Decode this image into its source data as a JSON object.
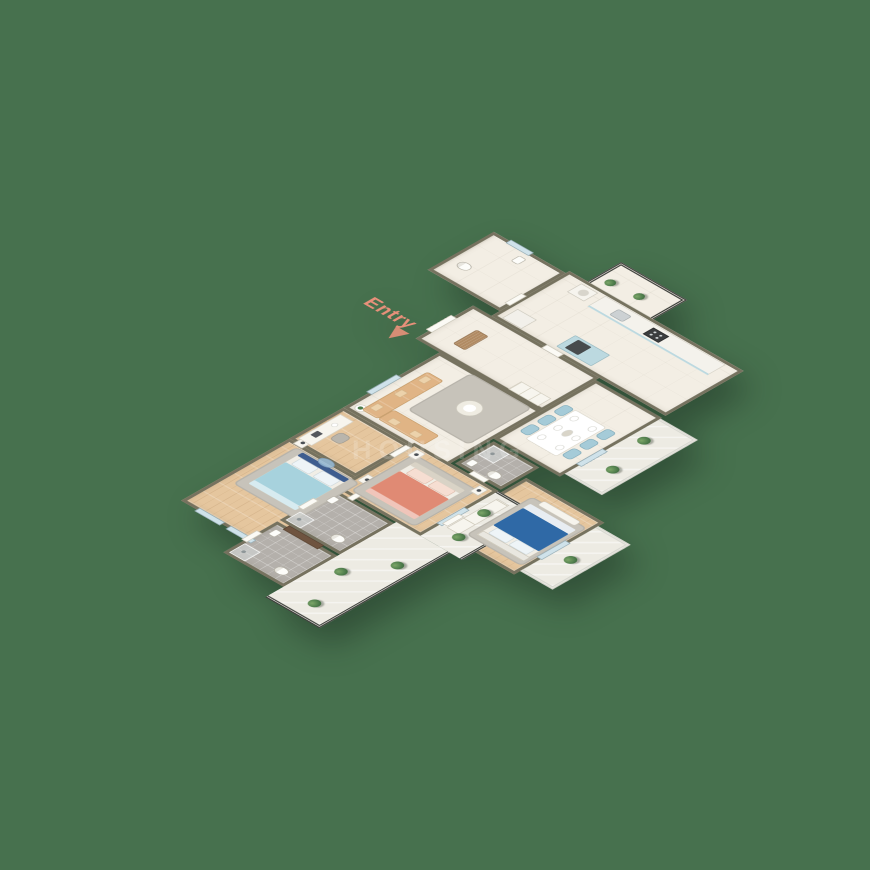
{
  "entry": {
    "label": "Entry"
  },
  "watermark": {
    "text": "HOUSING"
  },
  "palette": {
    "background": "#47714e",
    "wall": "#76725f",
    "floor_tile": "#f3eee4",
    "wood_floor": "#e5c69e",
    "bath_tile": "#b4b0ab",
    "balcony_floor": "#edebe3",
    "railing_dark": "#3f413d",
    "railing_light": "#d8d8d1",
    "bed1_blanket": "#a7d2dd",
    "bed1_frame": "#3e5d8f",
    "bed2_blanket": "#e08a74",
    "bed3_blanket": "#2f69a6",
    "sofa": "#e0b485",
    "sofa_cushion": "#ecd2ab",
    "dining_chair": "#a5cbd8",
    "kitchen_cabinet": "#bcd9e0",
    "rug": "#c7c3ba",
    "plant": "#4c7a4a",
    "doormat": "#b18b63",
    "vanity_wood": "#6f5440",
    "entry_accent": "#e8907a"
  },
  "rooms": [
    "bedroom-1",
    "study-nook",
    "living-room",
    "foyer",
    "utility-toilet",
    "kitchen",
    "bathroom-1",
    "bathroom-2",
    "bedroom-2",
    "bathroom-3",
    "dining-area",
    "bedroom-3",
    "balcony-left",
    "balcony-bedroom-3",
    "balcony-dining",
    "service-balcony"
  ]
}
